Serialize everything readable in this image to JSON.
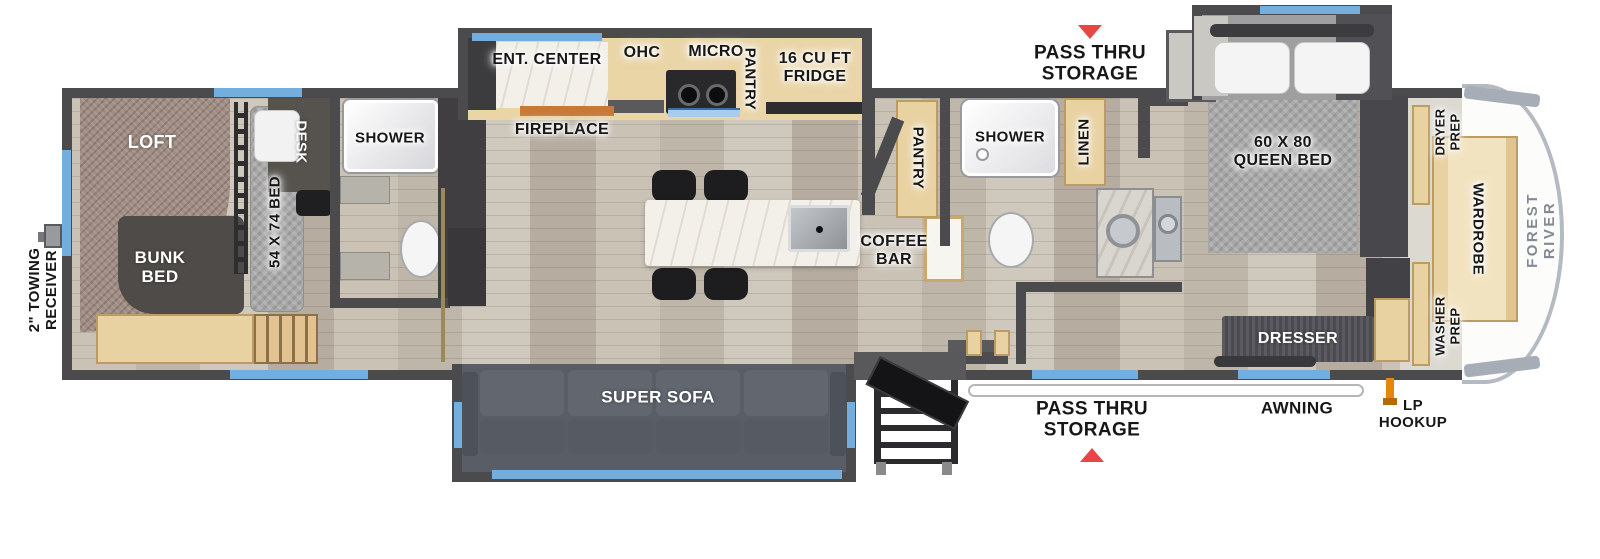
{
  "plan": {
    "type": "fifth-wheel RV floor plan",
    "brand": "FOREST RIVER"
  },
  "colors": {
    "wall_gray": "#4b4b4d",
    "window_blue": "#74aede",
    "arrow_red": "#e84545",
    "lp_orange": "#e8860c",
    "cabinet_tan": "#e9d2a2"
  },
  "labels": {
    "pass_thru_top": "PASS THRU\nSTORAGE",
    "ent_center": "ENT. CENTER",
    "ohc": "OHC",
    "micro": "MICRO",
    "pantry_kitchen": "PANTRY",
    "fridge": "16 CU FT\nFRIDGE",
    "fireplace": "FIREPLACE",
    "loft": "LOFT",
    "desk": "DESK",
    "shower_rear": "SHOWER",
    "bed54": "54 X 74 BED",
    "bunk": "BUNK\nBED",
    "towing": "2\" TOWING\nRECEIVER",
    "pantry_mid": "PANTRY",
    "shower_mid": "SHOWER",
    "linen": "LINEN",
    "queen": "60 X 80\nQUEEN BED",
    "coffee": "COFFEE\nBAR",
    "sofa": "SUPER SOFA",
    "dresser": "DRESSER",
    "dryer": "DRYER\nPREP",
    "washer": "WASHER\nPREP",
    "wardrobe": "WARDROBE",
    "brand": "FOREST RIVER",
    "pass_thru_bottom": "PASS THRU\nSTORAGE",
    "awning": "AWNING",
    "lp": "LP\nHOOKUP"
  }
}
